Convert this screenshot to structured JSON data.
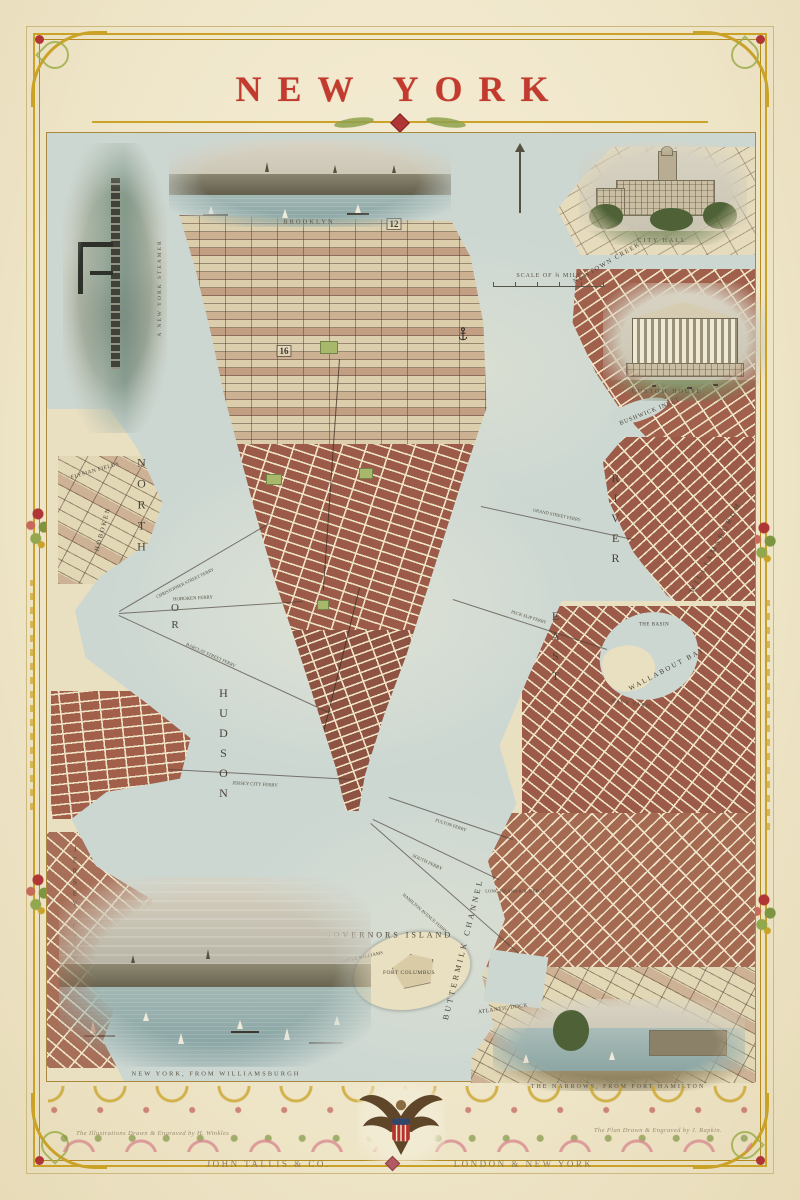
{
  "title": "NEW YORK",
  "imprint": {
    "publisher": "JOHN TALLIS & CO.",
    "cities": "LONDON & NEW YORK"
  },
  "credits": {
    "left": "The Illustrations Drawn & Engraved by H. Winkles",
    "right": "The Plan Drawn & Engraved by J. Rapkin."
  },
  "scale": {
    "label": "SCALE OF ¾ MILE"
  },
  "vignettes": {
    "brooklyn": {
      "caption": "BROOKLYN"
    },
    "city_hall": {
      "caption": "CITY HALL"
    },
    "custom_house": {
      "caption": "CUSTOM HOUSE"
    },
    "steamer": {
      "caption": "A NEW YORK STEAMER"
    },
    "williamsburgh_view": {
      "caption": "NEW YORK, FROM WILLIAMSBURGH"
    },
    "narrows_view": {
      "caption": "THE NARROWS, FROM FORT HAMILTON"
    }
  },
  "ward_numbers": [
    {
      "text": "16",
      "x": 283,
      "y": 350
    },
    {
      "text": "12",
      "x": 393,
      "y": 223
    }
  ],
  "map_labels": [
    {
      "text": "NORTH",
      "x": 140,
      "y": 507,
      "size": 12,
      "ls": 7,
      "vert": true
    },
    {
      "text": "OR",
      "x": 174,
      "y": 618,
      "size": 11,
      "ls": 5,
      "vert": true
    },
    {
      "text": "HUDSON",
      "x": 222,
      "y": 745,
      "size": 12,
      "ls": 6,
      "vert": true
    },
    {
      "text": "RIVER",
      "x": 614,
      "y": 520,
      "size": 12,
      "ls": 6,
      "vert": true
    },
    {
      "text": "EAST",
      "x": 554,
      "y": 648,
      "size": 12,
      "ls": 6,
      "vert": true
    },
    {
      "text": "NEWTOWN CREEK",
      "x": 606,
      "y": 262,
      "size": 6.5,
      "ls": 1.5,
      "rot": -30
    },
    {
      "text": "BUSHWICK INLET",
      "x": 649,
      "y": 411,
      "size": 6,
      "ls": 1,
      "rot": -22
    },
    {
      "text": "WILLIAMSBURGH",
      "x": 714,
      "y": 546,
      "size": 7.5,
      "ls": 3,
      "rot": -62
    },
    {
      "text": "WALLABOUT BAY",
      "x": 666,
      "y": 668,
      "size": 7,
      "ls": 2,
      "rot": -28
    },
    {
      "text": "NAVY YARD",
      "x": 630,
      "y": 703,
      "size": 5.5,
      "ls": 1,
      "rot": 8
    },
    {
      "text": "THE BASIN",
      "x": 653,
      "y": 624,
      "size": 5,
      "ls": 0.5,
      "rot": 0
    },
    {
      "text": "GOVERNORS ISLAND",
      "x": 388,
      "y": 934,
      "size": 8,
      "ls": 3,
      "rot": 0
    },
    {
      "text": "FORT COLUMBUS",
      "x": 408,
      "y": 972,
      "size": 5.5,
      "ls": 0.5,
      "rot": 0
    },
    {
      "text": "CASTLE WILLIAMS",
      "x": 360,
      "y": 956,
      "size": 4.5,
      "ls": 0.3,
      "rot": -12
    },
    {
      "text": "BUTTERMILK CHANNEL",
      "x": 462,
      "y": 948,
      "size": 8,
      "ls": 3,
      "rot": -76
    },
    {
      "text": "ATLANTIC DOCK",
      "x": 502,
      "y": 1008,
      "size": 5.5,
      "ls": 0.5,
      "rot": -8
    },
    {
      "text": "LONG ISLAND R.R. DEPOT",
      "x": 514,
      "y": 890,
      "size": 4.5,
      "ls": 0.2,
      "rot": 0
    },
    {
      "text": "ELYSIAN FIELDS",
      "x": 94,
      "y": 470,
      "size": 5.5,
      "ls": 0.5,
      "rot": -16
    },
    {
      "text": "HOBOKEN",
      "x": 102,
      "y": 528,
      "size": 6.5,
      "ls": 2,
      "rot": -75
    },
    {
      "text": "JERSEY CITY",
      "x": 74,
      "y": 905,
      "size": 7,
      "ls": 3,
      "vert": true
    }
  ],
  "ferries": [
    {
      "label": "HOBOKEN FERRY",
      "x1": 118,
      "y1": 612,
      "x2": 302,
      "y2": 600,
      "lx": 192,
      "ly": 598,
      "rot": -3,
      "size": 4.8
    },
    {
      "label": "CHRISTOPHER STREET FERRY",
      "x1": 118,
      "y1": 610,
      "x2": 268,
      "y2": 522,
      "lx": 184,
      "ly": 582,
      "rot": -26,
      "size": 4.5
    },
    {
      "label": "BARCLAY STREET FERRY",
      "x1": 118,
      "y1": 614,
      "x2": 330,
      "y2": 712,
      "lx": 210,
      "ly": 654,
      "rot": 24,
      "size": 4.5
    },
    {
      "label": "JERSEY CITY FERRY",
      "x1": 168,
      "y1": 768,
      "x2": 352,
      "y2": 778,
      "lx": 254,
      "ly": 784,
      "rot": 3,
      "size": 4.8
    },
    {
      "label": "SOUTH FERRY",
      "x1": 372,
      "y1": 818,
      "x2": 498,
      "y2": 878,
      "lx": 426,
      "ly": 862,
      "rot": 25,
      "size": 4.8
    },
    {
      "label": "HAMILTON AVENUE FERRY",
      "x1": 370,
      "y1": 822,
      "x2": 518,
      "y2": 952,
      "lx": 424,
      "ly": 912,
      "rot": 41,
      "size": 4.5
    },
    {
      "label": "FULTON FERRY",
      "x1": 388,
      "y1": 796,
      "x2": 512,
      "y2": 838,
      "lx": 450,
      "ly": 824,
      "rot": 18,
      "size": 4.5
    },
    {
      "label": "GRAND STREET FERRY",
      "x1": 480,
      "y1": 505,
      "x2": 632,
      "y2": 538,
      "lx": 556,
      "ly": 514,
      "rot": 12,
      "size": 4.5
    },
    {
      "label": "PECK SLIP FERRY",
      "x1": 452,
      "y1": 598,
      "x2": 606,
      "y2": 648,
      "lx": 528,
      "ly": 616,
      "rot": 17,
      "size": 4.5
    }
  ],
  "colors": {
    "title_red": "#c23b2e",
    "border_gold": "#c9a227",
    "water": "#ccd7d2",
    "land_cream": "#e9dfc1",
    "block_brick": "#9b5b48",
    "engraving_ink": "#4a4438"
  },
  "icons": {
    "compass": "north-needle",
    "anchor": "dry-dock-anchor",
    "eagle": "us-eagle-shield-crest"
  }
}
